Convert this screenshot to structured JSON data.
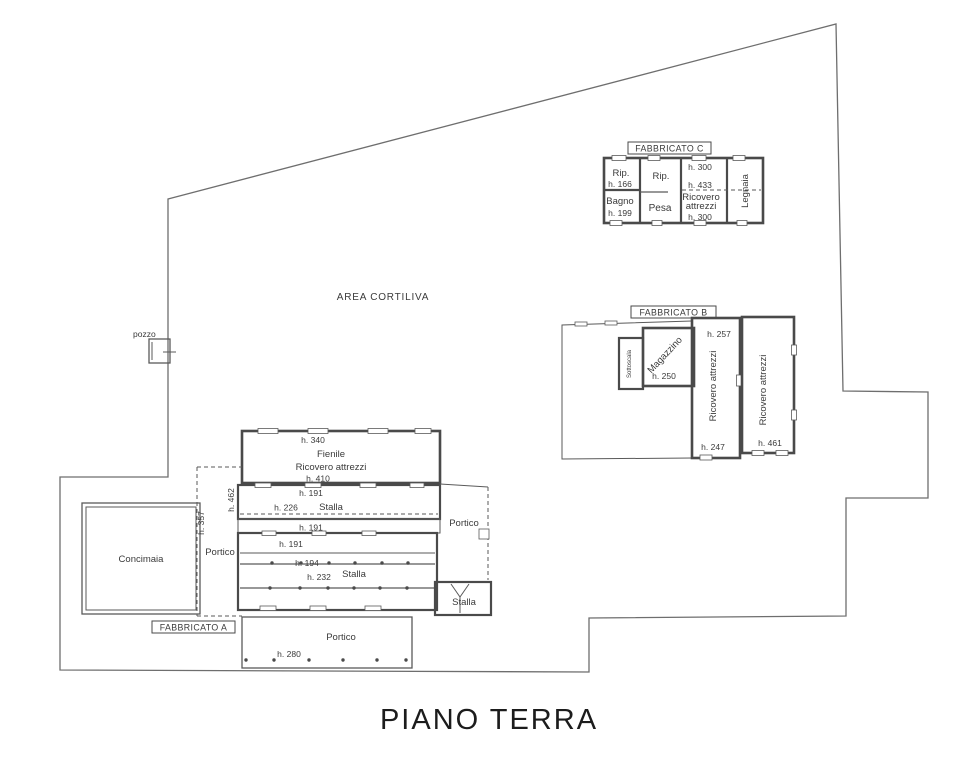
{
  "title": "PIANO TERRA",
  "site": {
    "courtyard_label": "AREA CORTILIVA",
    "well_label": "pozzo"
  },
  "fabbricato_c": {
    "label": "FABBRICATO C",
    "rip1": "Rip.",
    "rip1_h": "h. 166",
    "rip2": "Rip.",
    "h300_top": "h. 300",
    "h433": "h. 433",
    "bagno": "Bagno",
    "bagno_h": "h. 199",
    "pesa": "Pesa",
    "ricovero_line1": "Ricovero",
    "ricovero_line2": "attrezzi",
    "ricovero_h": "h. 300",
    "legnaia": "Legnaia"
  },
  "fabbricato_b": {
    "label": "FABBRICATO B",
    "sottoscala": "Sottoscala",
    "magazzino": "Magazzino",
    "magazzino_h": "h. 250",
    "ricovero1": "Ricovero attrezzi",
    "ricovero1_h_top": "h. 257",
    "ricovero1_h_bottom": "h. 247",
    "ricovero2": "Ricovero attrezzi",
    "ricovero2_h": "h. 461"
  },
  "fabbricato_a": {
    "label": "FABBRICATO A",
    "fienile_h_top": "h. 340",
    "fienile_line1": "Fienile",
    "fienile_line2": "Ricovero attrezzi",
    "fienile_h_bottom": "h. 410",
    "stalla1_h_top": "h. 191",
    "stalla1_h_mid": "h.  226",
    "stalla1_label": "Stalla",
    "corridor_h": "h. 191",
    "stalla2_h_top": "h. 191",
    "stalla2_h_mid": "h. 194",
    "stalla2_h_low": "h.  232",
    "stalla2_label": "Stalla",
    "portico_left": "Portico",
    "portico_left_h": "h. 357",
    "side_h": "h. 462",
    "concimaia": "Concimaia",
    "portico_right": "Portico",
    "stalla_small": "Stalla",
    "portico_bottom": "Portico",
    "portico_bottom_h": "h. 280"
  }
}
